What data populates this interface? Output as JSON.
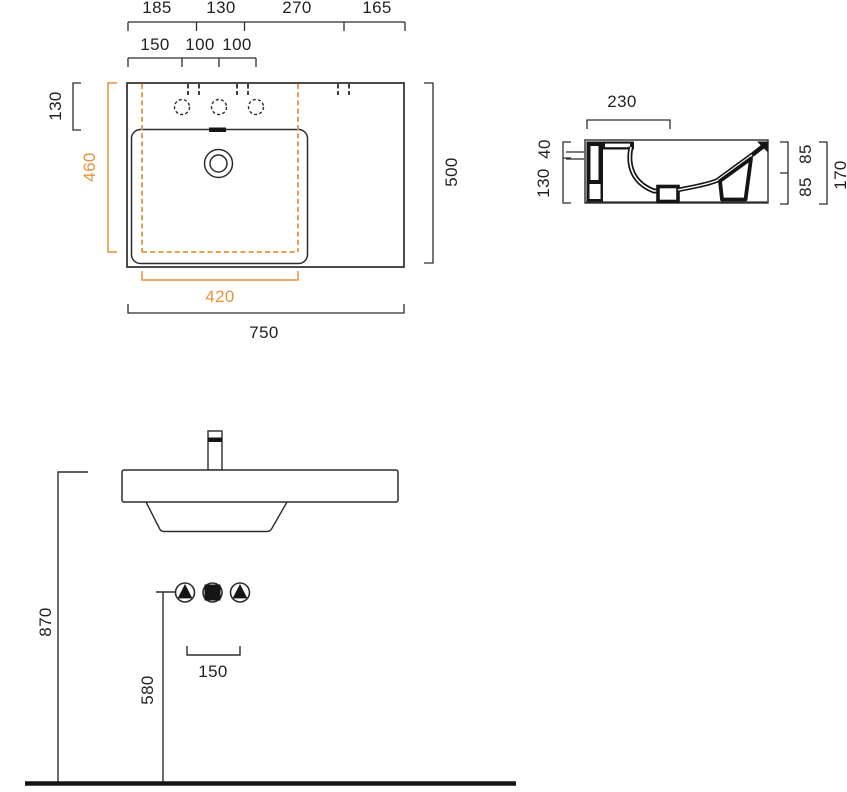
{
  "meta": {
    "type": "technical-drawing",
    "subject": "wall-hung washbasin installation dimensions",
    "views": [
      "top plan view",
      "side section view",
      "front elevation view"
    ]
  },
  "colors": {
    "line": "#2e2c2b",
    "section_line": "#171513",
    "accent_orange": "#e8923d",
    "text": "#231f20",
    "background": "#ffffff"
  },
  "top_view": {
    "dim_chain_top": [
      "185",
      "130",
      "270",
      "165"
    ],
    "dim_chain_tap_holes": [
      "150",
      "100",
      "100"
    ],
    "dim_tap_deck_depth": "130",
    "dim_bowl_depth": "460",
    "dim_overall_depth": "500",
    "dim_bowl_width": "420",
    "dim_overall_width": "750"
  },
  "side_view": {
    "dim_deck_width": "230",
    "dim_rim_thickness": "40",
    "dim_skirt_height": "130",
    "dim_front_upper": "85",
    "dim_front_lower": "85",
    "dim_total_height": "170"
  },
  "front_view": {
    "dim_rim_height": "870",
    "dim_connection_height": "580",
    "dim_drain_offset": "150"
  }
}
